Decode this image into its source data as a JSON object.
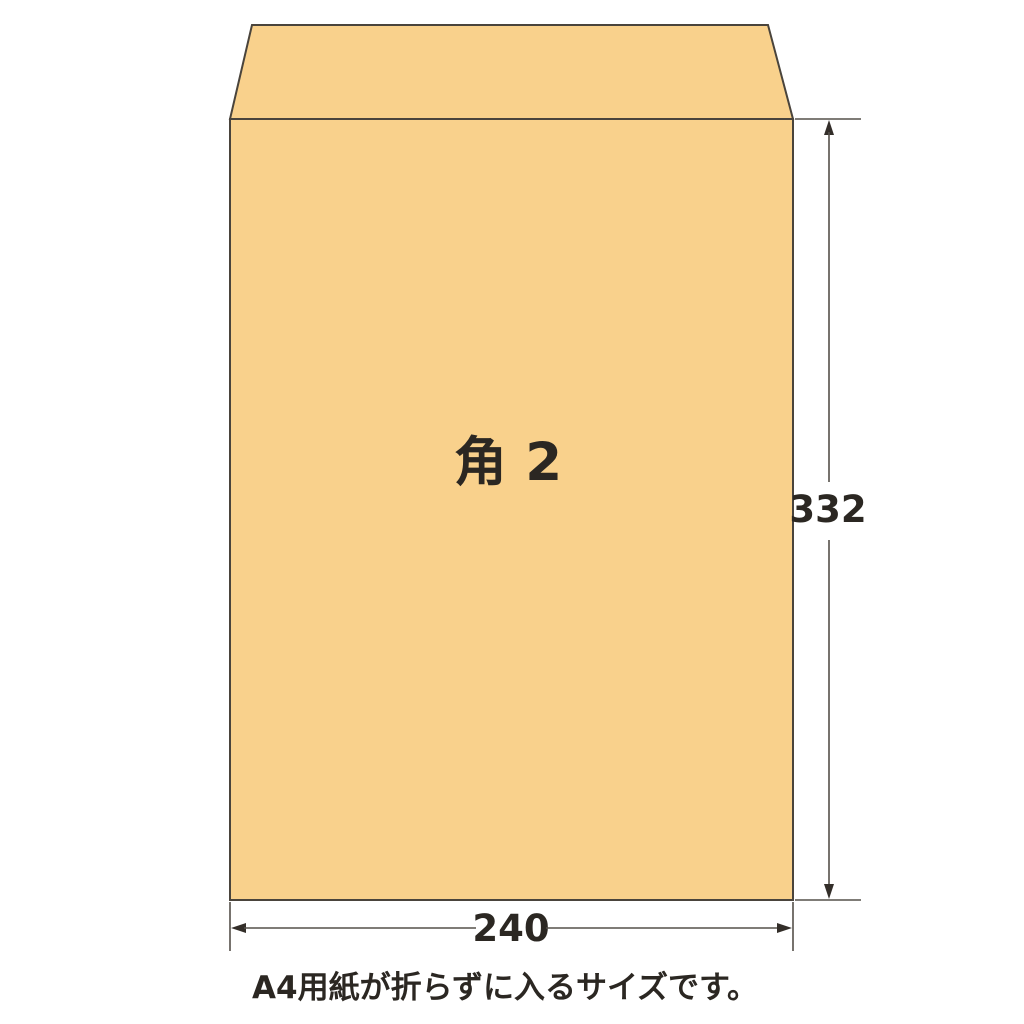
{
  "diagram": {
    "envelope": {
      "label": "角 2",
      "height_label": "332",
      "width_label": "240"
    },
    "caption": "A4用紙が折らずに入るサイズです。"
  },
  "colors": {
    "background": "#FFFFFF",
    "envelope_fill": "#F9D18C",
    "outline": "#4A443C",
    "dimension_line": "#55504A",
    "arrow": "#332E29",
    "text": "#2B2722"
  }
}
